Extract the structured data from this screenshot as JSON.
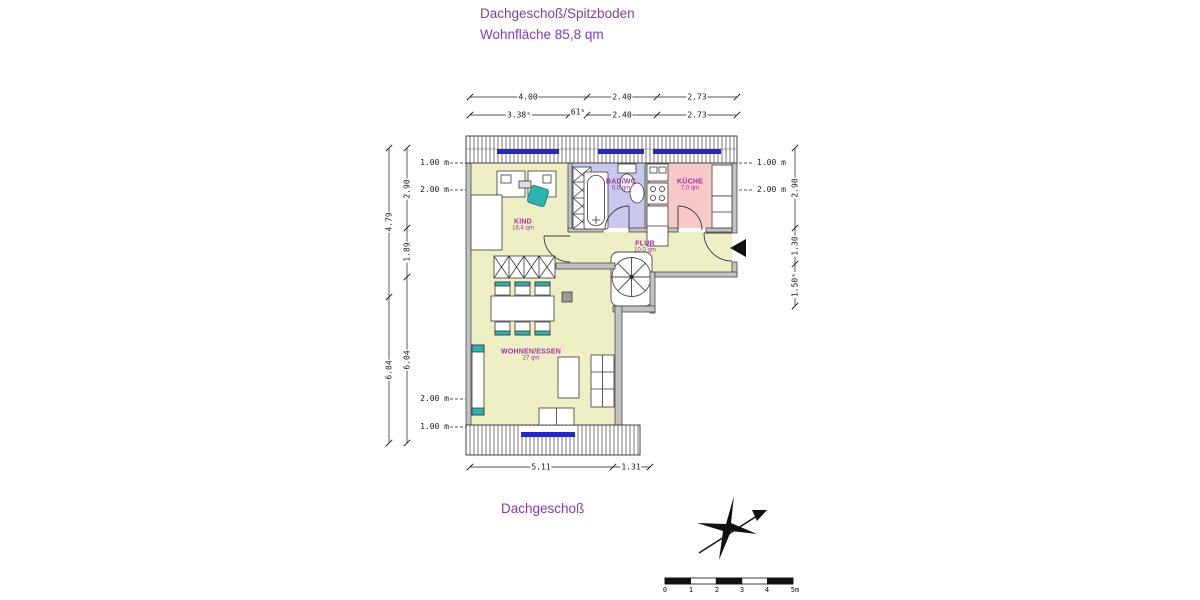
{
  "page": {
    "title_line1": "Dachgeschoß/Spitzboden",
    "title_line2": "Wohnfläche 85,8 qm",
    "footer_label": "Dachgeschoß"
  },
  "rooms": {
    "kind": {
      "name": "KIND",
      "area": "18,4 qm"
    },
    "bad": {
      "name": "BAD/WC",
      "area": "6,0 qm"
    },
    "kueche": {
      "name": "KÜCHE",
      "area": "7,0 qm"
    },
    "flur": {
      "name": "FLUR",
      "area": "10,0 qm"
    },
    "wohnen": {
      "name": "WOHNEN/ESSEN",
      "area": "27 qm"
    }
  },
  "dimensions": {
    "top_row1": {
      "d1": "4.00",
      "d2": "2.40",
      "d3": "2.73"
    },
    "top_row2": {
      "d1": "3.38⁵",
      "d2": "61⁵",
      "d3": "2.40",
      "d4": "2.73"
    },
    "left_outer": {
      "d1": "4.79",
      "d2": "6.04"
    },
    "left_inner": {
      "d1": "2.90",
      "d2": "1.89",
      "d3": "6.04"
    },
    "right_chain": {
      "d1": "2.90",
      "d2": "1.30",
      "d3": "1.50⁵"
    },
    "bottom": {
      "d1": "5.11",
      "d2": "1.31"
    },
    "heights": {
      "h1": "1.00 m",
      "h2": "2.00 m"
    }
  },
  "scale_bar": {
    "t0": "0",
    "t1": "1",
    "t2": "2",
    "t3": "3",
    "t4": "4",
    "t5": "5m"
  },
  "colors": {
    "accent_purple": "#7a3fb5",
    "room_label": "#a231a2",
    "room_yellow": "#efefc5",
    "room_lavender": "#c9c9f0",
    "room_pink": "#f7c9c9",
    "wall_gray": "#c2c2c2",
    "window_blue": "#2525d0",
    "furniture_teal": "#2bb3ae"
  }
}
